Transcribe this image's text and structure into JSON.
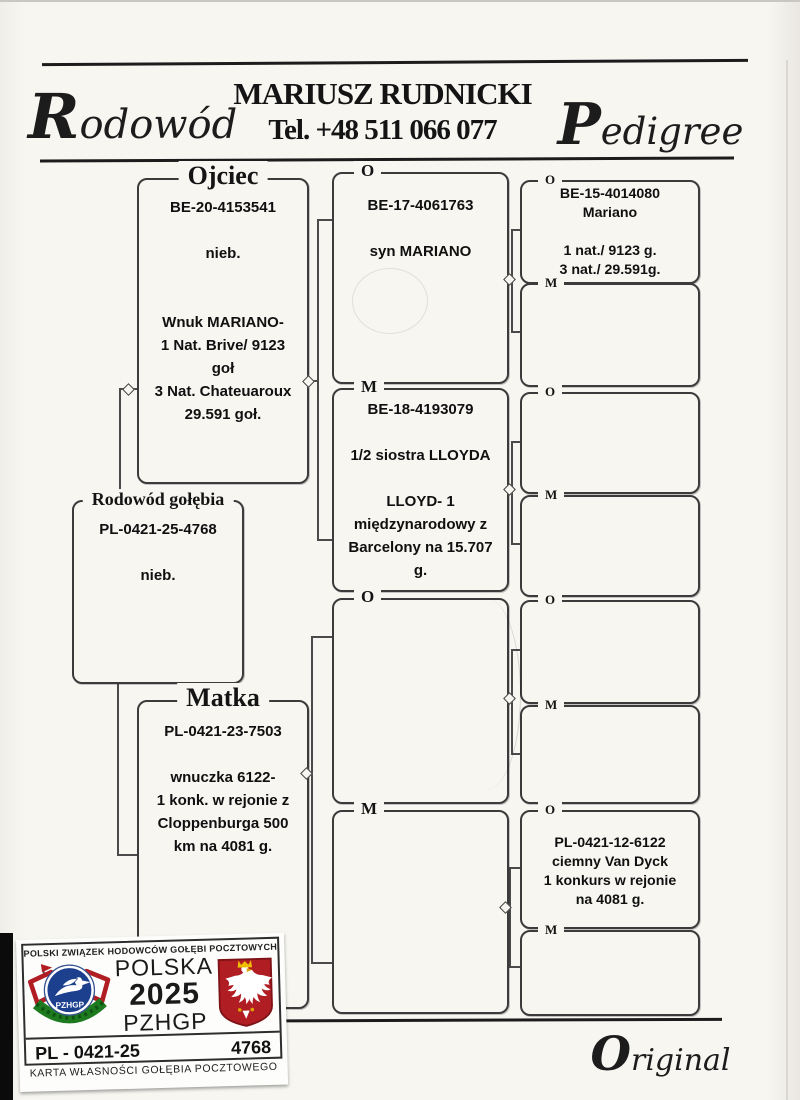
{
  "header": {
    "script_left": "Rodowód",
    "owner_name": "MARIUSZ RUDNICKI",
    "phone": "Tel. +48 511 066 077",
    "script_right": "Pedigree"
  },
  "pedigree": {
    "father": {
      "frame_label": "Ojciec",
      "lines": [
        "BE-20-4153541",
        "",
        "nieb.",
        "",
        "",
        "Wnuk MARIANO-",
        "1 Nat. Brive/ 9123",
        "goł",
        "3 Nat. Chateuaroux",
        "29.591 goł."
      ]
    },
    "subject": {
      "frame_label": "Rodowód gołębia",
      "lines": [
        "PL-0421-25-4768",
        "",
        "nieb."
      ]
    },
    "mother": {
      "frame_label": "Matka",
      "lines": [
        "PL-0421-23-7503",
        "",
        "wnuczka 6122-",
        "1 konk. w rejonie z",
        "Cloppenburga 500",
        "km na 4081 g."
      ]
    },
    "gen3": [
      {
        "tag": "O",
        "lines": [
          "BE-17-4061763",
          "",
          "syn MARIANO"
        ]
      },
      {
        "tag": "M",
        "lines": [
          "BE-18-4193079",
          "",
          "1/2 siostra LLOYDA",
          "",
          "LLOYD- 1",
          "międzynarodowy z",
          "Barcelony na 15.707",
          "g."
        ]
      },
      {
        "tag": "O",
        "lines": []
      },
      {
        "tag": "M",
        "lines": []
      }
    ],
    "gen4": [
      {
        "tag": "O",
        "lines": [
          "BE-15-4014080",
          "Mariano",
          "",
          "1 nat./ 9123 g.",
          "3 nat./ 29.591g."
        ]
      },
      {
        "tag": "M",
        "lines": []
      },
      {
        "tag": "O",
        "lines": []
      },
      {
        "tag": "M",
        "lines": []
      },
      {
        "tag": "O",
        "lines": []
      },
      {
        "tag": "M",
        "lines": []
      },
      {
        "tag": "O",
        "lines": [
          "PL-0421-12-6122",
          "ciemny Van Dyck",
          "1 konkurs w rejonie",
          "na 4081 g."
        ]
      },
      {
        "tag": "M",
        "lines": []
      }
    ]
  },
  "sticker": {
    "association": "POLSKI ZWIĄZEK HODOWCÓW GOŁĘBI POCZTOWYCH",
    "country": "POLSKA",
    "year": "2025",
    "org": "PZHGP",
    "logo_text": "PZHGP",
    "ring_prefix": "PL - 0421-25",
    "ring_number": "4768",
    "caption": "KARTA  WŁASNOŚCI GOŁĘBIA POCZTOWEGO",
    "colors": {
      "red": "#b01e24",
      "blue": "#1c3f8e",
      "green": "#1d7a1f",
      "gold": "#eebe00"
    }
  },
  "footer": {
    "script": "Original"
  }
}
